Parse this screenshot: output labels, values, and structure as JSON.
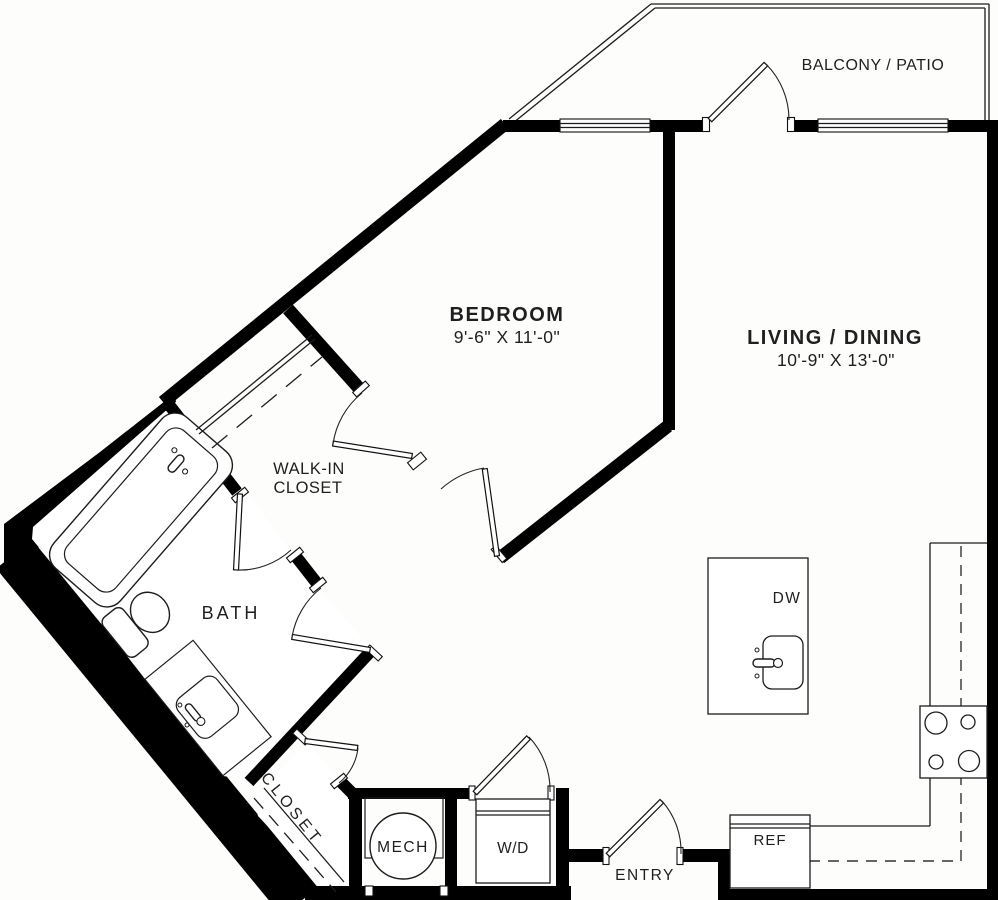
{
  "palette": {
    "wall": "#000000",
    "text": "#1f1f1f",
    "background": "#fdfdfc"
  },
  "rooms": {
    "balcony": {
      "label": "BALCONY / PATIO"
    },
    "bedroom": {
      "label": "BEDROOM",
      "dims": "9'-6\" X 11'-0\""
    },
    "living": {
      "label": "LIVING / DINING",
      "dims": "10'-9\" X 13'-0\""
    },
    "walk_in_closet": {
      "label_line1": "WALK-IN",
      "label_line2": "CLOSET"
    },
    "bath": {
      "label": "BATH"
    },
    "closet": {
      "label": "CLOSET"
    },
    "mech": {
      "label": "MECH"
    },
    "laundry": {
      "label": "W/D"
    },
    "entry": {
      "label": "ENTRY"
    }
  },
  "appliances": {
    "refrigerator": {
      "label": "REF"
    },
    "dishwasher": {
      "label": "DW"
    }
  }
}
